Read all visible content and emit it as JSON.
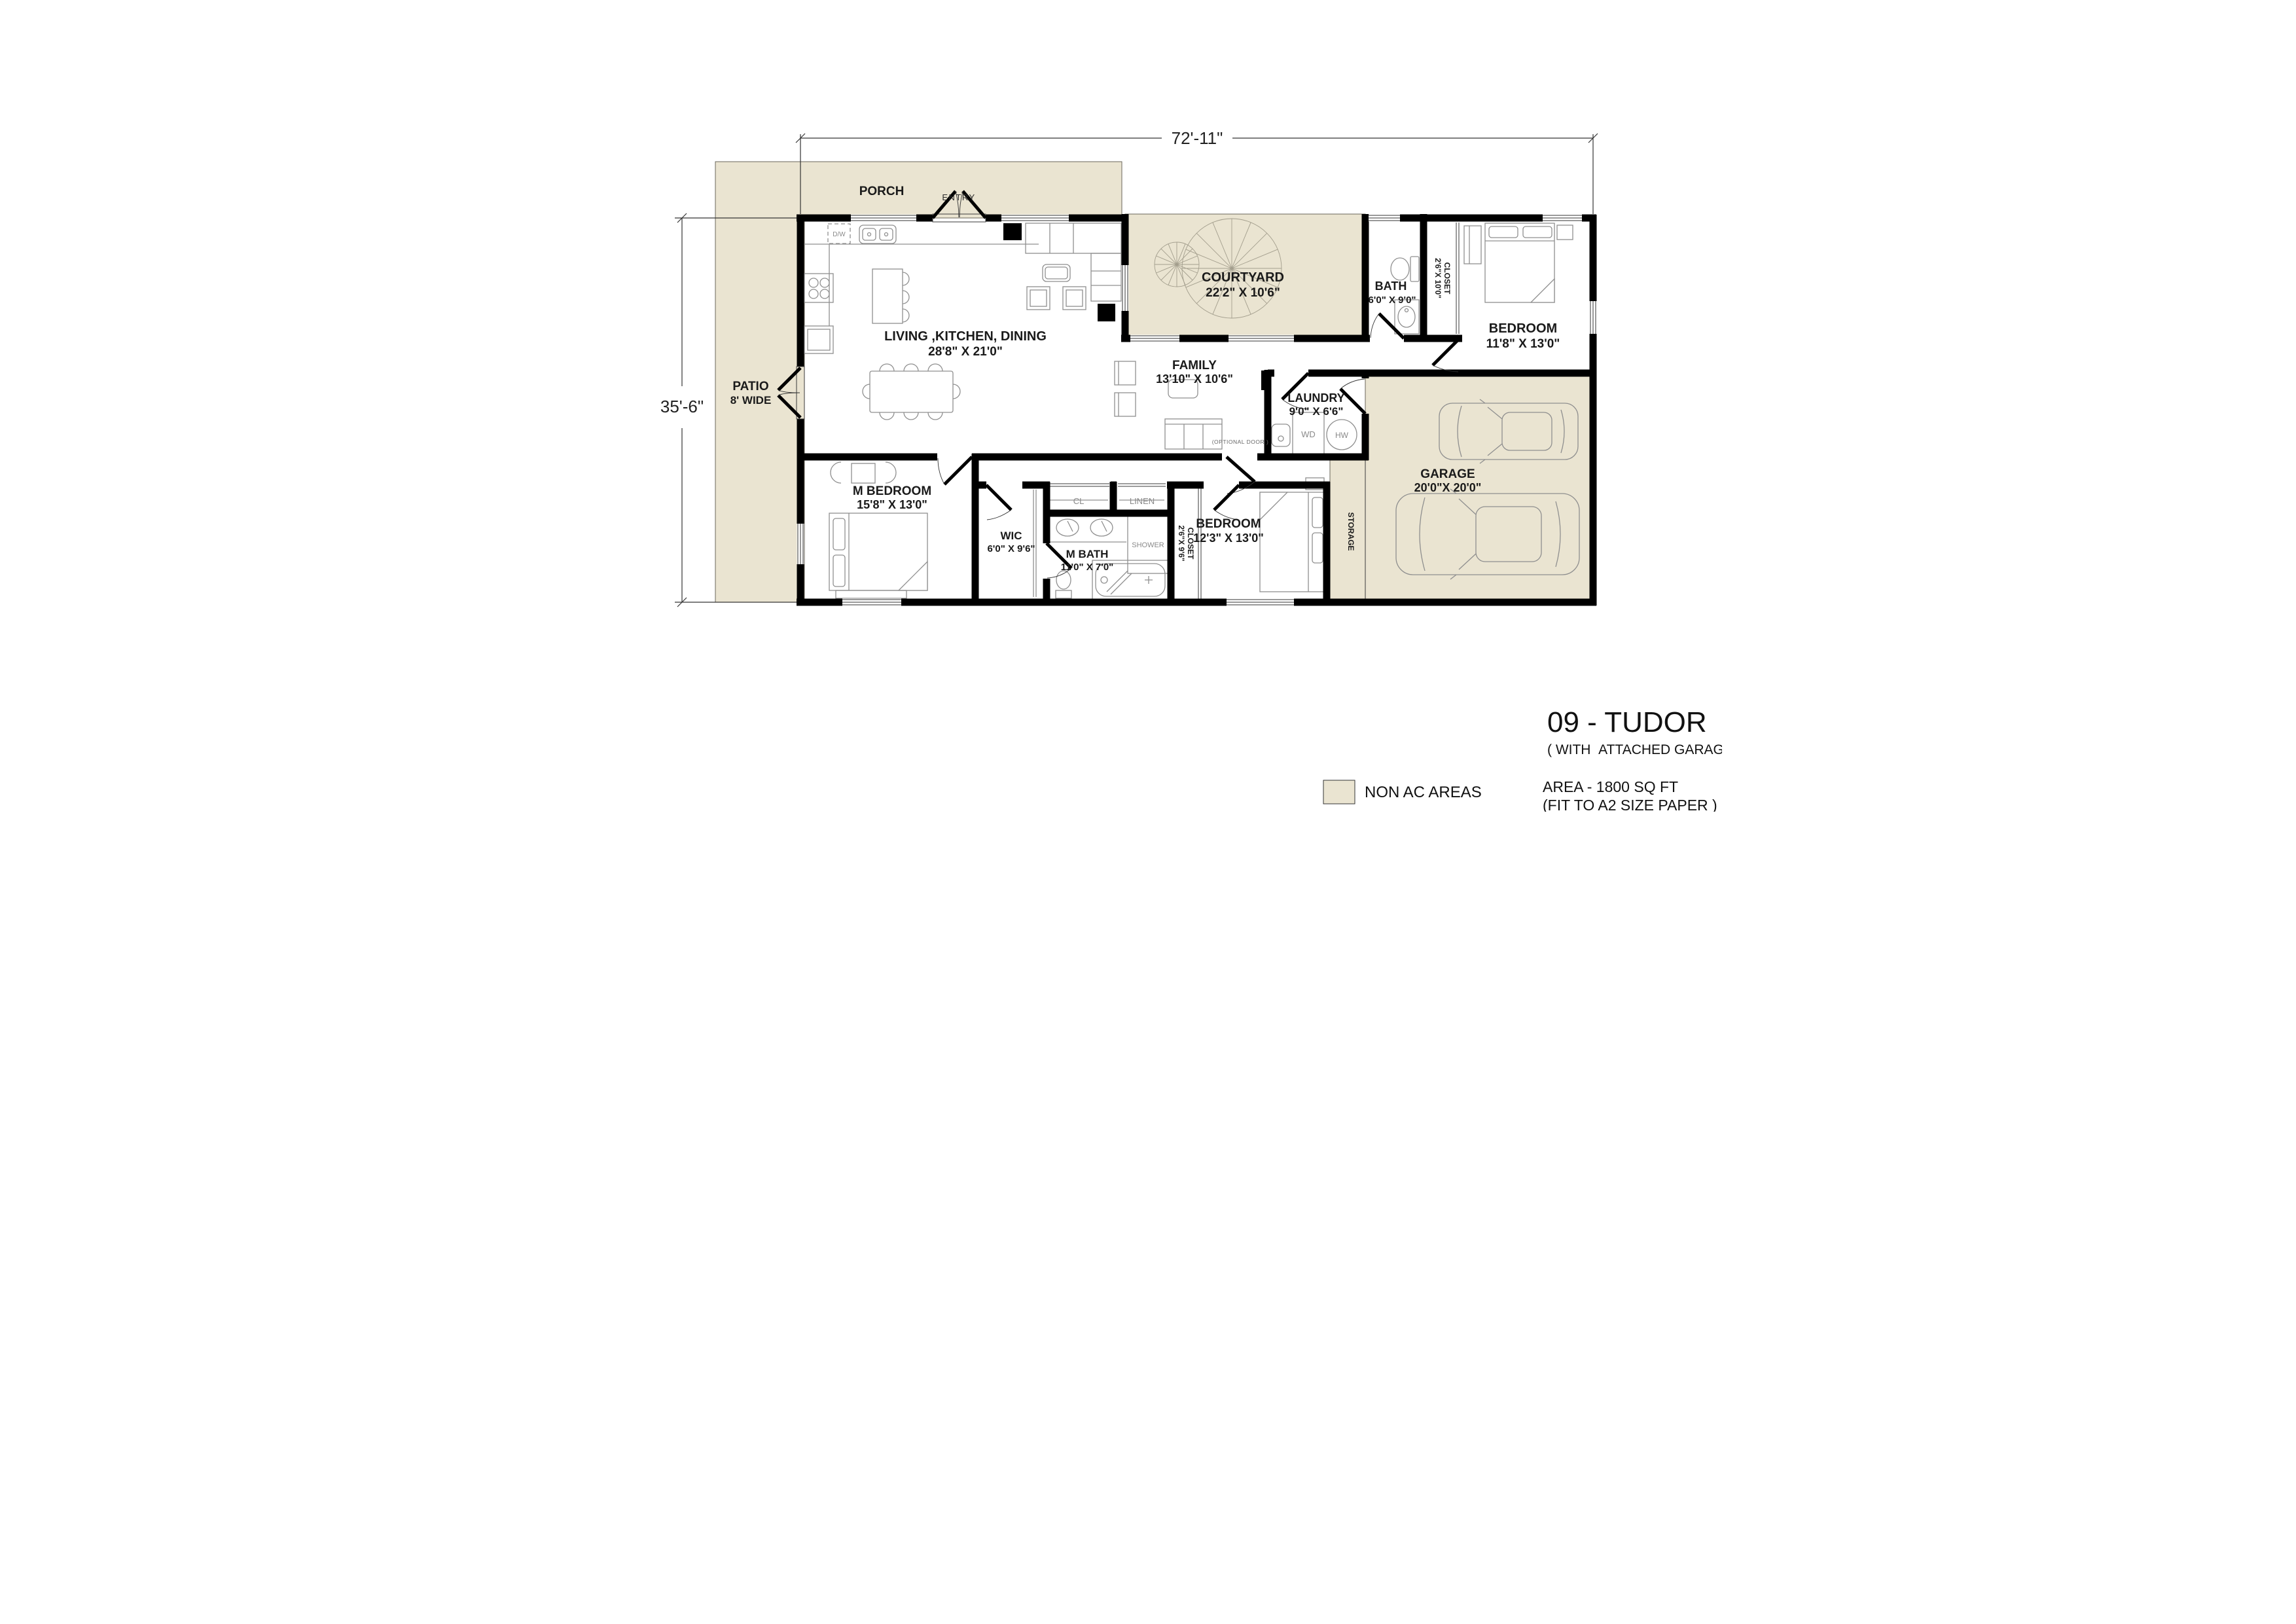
{
  "colors": {
    "non_ac": "#EAE4D1",
    "wall": "#000000"
  },
  "dimensions": {
    "width": "72'-11\"",
    "height": "35'-6\""
  },
  "rooms": {
    "porch": {
      "name": "PORCH"
    },
    "entry": {
      "name": "ENTRY"
    },
    "patio": {
      "name": "PATIO",
      "dims": "8' WIDE"
    },
    "courtyard": {
      "name": "COURTYARD",
      "dims": "22'2\" X 10'6\""
    },
    "living": {
      "name": "LIVING ,KITCHEN, DINING",
      "dims": "28'8\" X 21'0\""
    },
    "family": {
      "name": "FAMILY",
      "dims": "13'10\" X 10'6\""
    },
    "bath": {
      "name": "BATH",
      "dims": "6'0\" X 9'0\""
    },
    "closet_top": {
      "name": "CLOSET",
      "dims": "2'6\"X 10'0\""
    },
    "bedroom_right": {
      "name": "BEDROOM",
      "dims": "11'8\" X 13'0\""
    },
    "laundry": {
      "name": "LAUNDRY",
      "dims": "9'0\" X 6'6\""
    },
    "m_bedroom": {
      "name": "M BEDROOM",
      "dims": "15'8\" X 13'0\""
    },
    "wic": {
      "name": "WIC",
      "dims": "6'0\" X 9'6\""
    },
    "m_bath": {
      "name": "M BATH",
      "dims": "11'0\" X 7'0\""
    },
    "cl": {
      "name": "CL"
    },
    "linen": {
      "name": "LINEN"
    },
    "shower": {
      "name": "SHOWER"
    },
    "closet_bottom": {
      "name": "CLOSET",
      "dims": "2'6\"X 9'6\""
    },
    "bedroom_bottom": {
      "name": "BEDROOM",
      "dims": "12'3\" X 13'0\""
    },
    "garage": {
      "name": "GARAGE",
      "dims": "20'0\"X 20'0\""
    },
    "storage": {
      "name": "STORAGE"
    }
  },
  "fixtures": {
    "dishwasher": "D/W",
    "washer_dryer": "WD",
    "water_heater": "HW",
    "optional_door": "(OPTIONAL DOOR )"
  },
  "legend": {
    "label": "NON AC AREAS"
  },
  "title_block": {
    "title": "09 - TUDOR",
    "subtitle": "( WITH  ATTACHED GARAGE )",
    "area": "AREA - 1800 SQ FT",
    "paper": "(FIT TO A2 SIZE PAPER )"
  }
}
